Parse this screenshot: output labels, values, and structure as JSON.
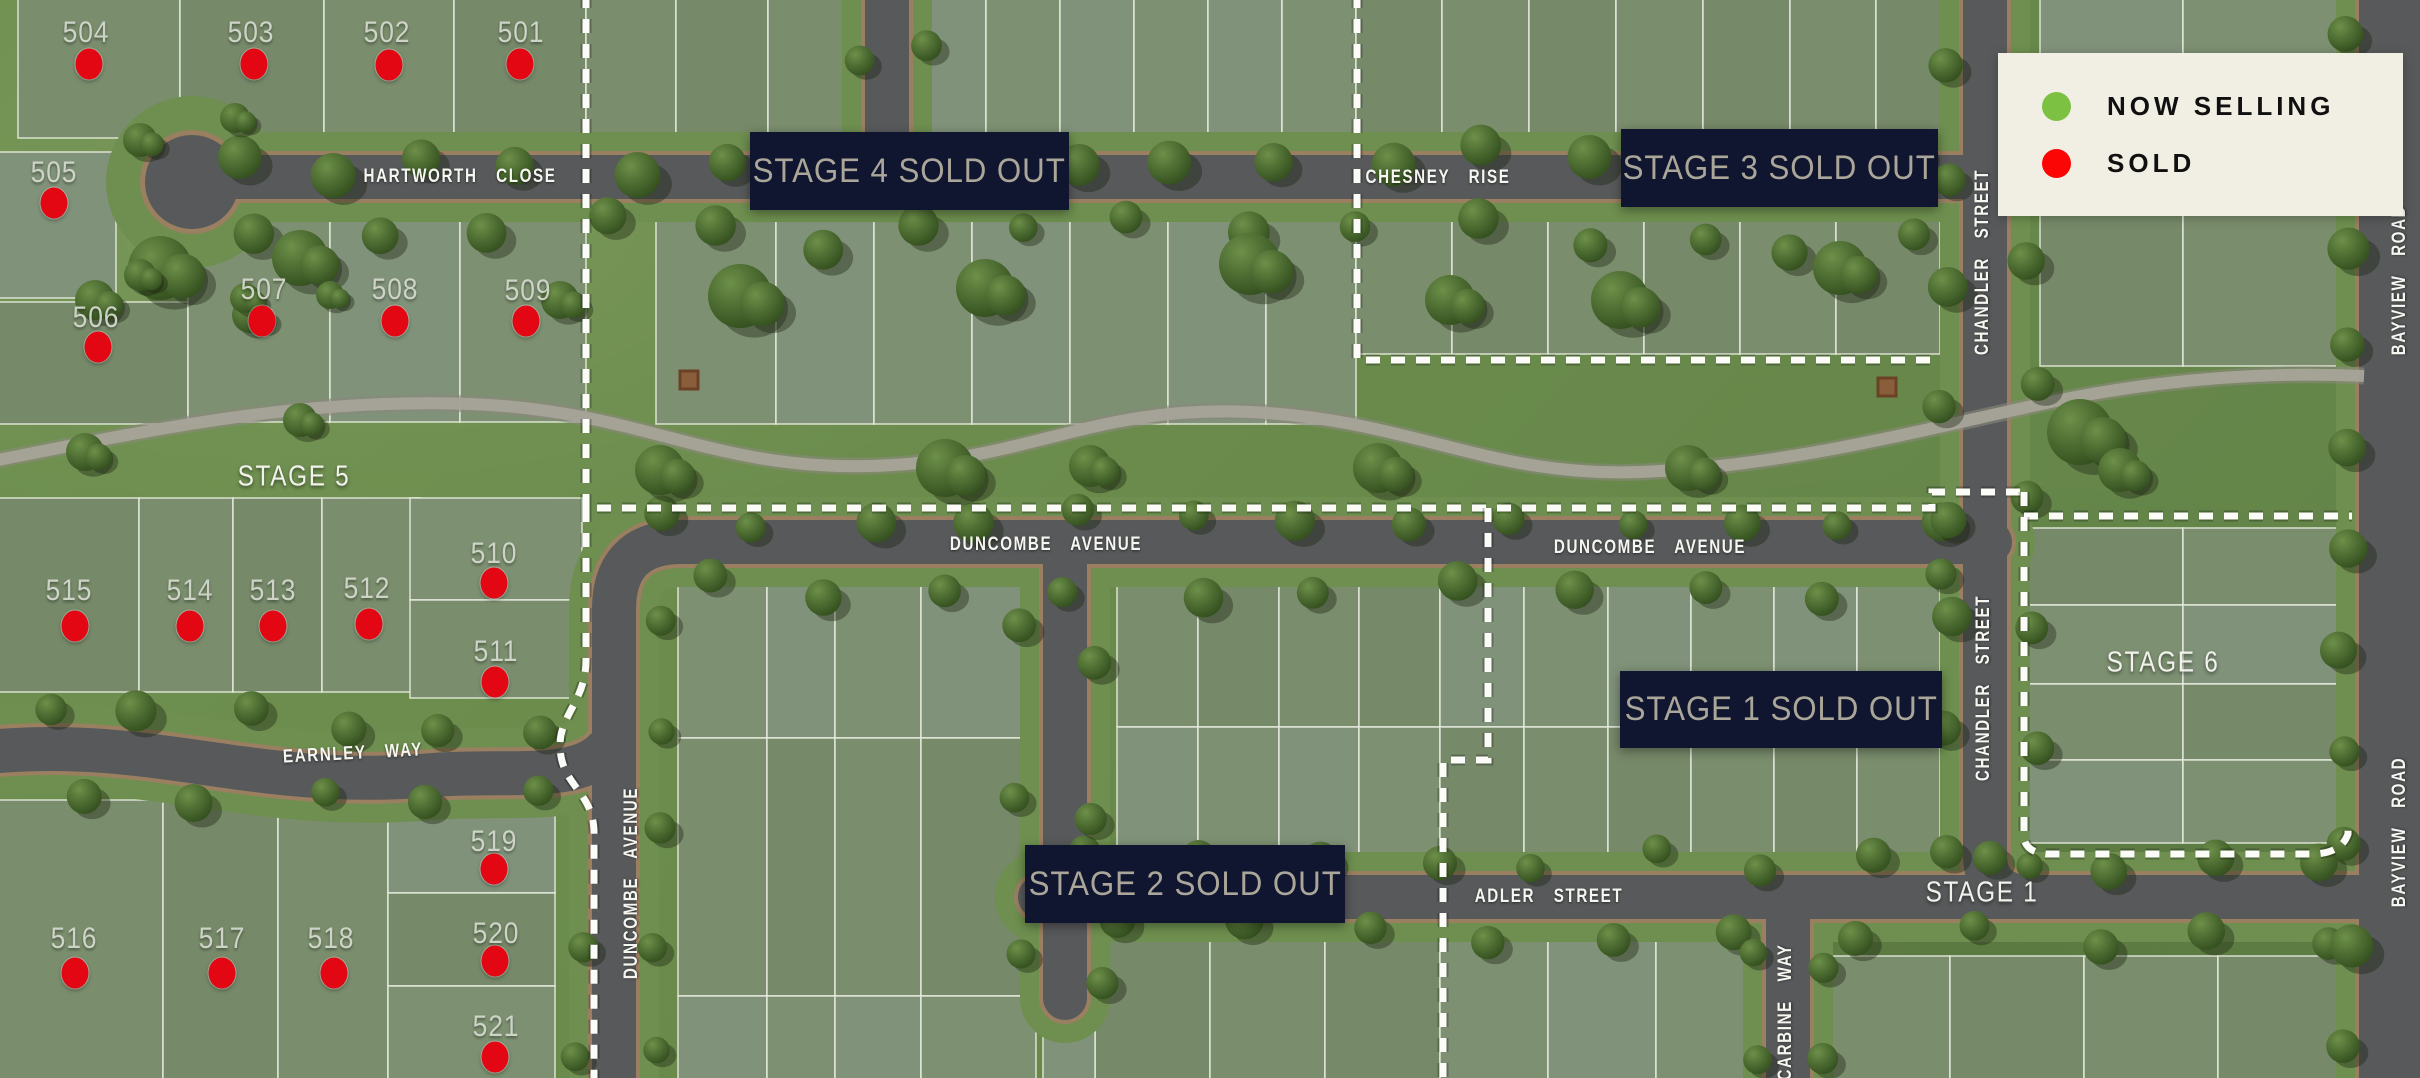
{
  "map_title": "Land estate masterplan",
  "legend": {
    "items": [
      {
        "id": "now-selling",
        "label": "NOW SELLING",
        "color": "#7dc142"
      },
      {
        "id": "sold",
        "label": "SOLD",
        "color": "#fb0505"
      }
    ],
    "x": 1998,
    "y": 53,
    "w": 361,
    "h": 163,
    "bg": "#f1eee3"
  },
  "colors": {
    "sold_dot": "#e30613",
    "banner_bg": "#10162f",
    "banner_text": "#aba69a"
  },
  "stage_banners": [
    {
      "label": "STAGE 4 SOLD OUT",
      "x": 750,
      "y": 132,
      "w": 319,
      "h": 78
    },
    {
      "label": "STAGE 3 SOLD OUT",
      "x": 1621,
      "y": 129,
      "w": 317,
      "h": 78
    },
    {
      "label": "STAGE 1 SOLD OUT",
      "x": 1620,
      "y": 671,
      "w": 322,
      "h": 77
    },
    {
      "label": "STAGE 2 SOLD OUT",
      "x": 1025,
      "y": 845,
      "w": 320,
      "h": 78
    }
  ],
  "stage_area_labels": [
    {
      "label": "STAGE 5",
      "x": 294,
      "y": 477
    },
    {
      "label": "STAGE 6",
      "x": 2163,
      "y": 663
    },
    {
      "label": "STAGE 1",
      "x": 1982,
      "y": 893
    }
  ],
  "streets": [
    {
      "name": "HARTWORTH  CLOSE",
      "x": 460,
      "y": 177,
      "angle": 0
    },
    {
      "name": "CHESNEY  RISE",
      "x": 1438,
      "y": 178,
      "angle": 0
    },
    {
      "name": "DUNCOMBE  AVENUE",
      "x": 1046,
      "y": 545,
      "angle": 0
    },
    {
      "name": "DUNCOMBE  AVENUE",
      "x": 1650,
      "y": 548,
      "angle": 0
    },
    {
      "name": "ADLER  STREET",
      "x": 1549,
      "y": 897,
      "angle": 0
    },
    {
      "name": "EARNLEY  WAY",
      "x": 353,
      "y": 754,
      "angle": -3
    },
    {
      "name": "CHANDLER  STREET",
      "x": 1983,
      "y": 262,
      "angle": -90
    },
    {
      "name": "CHANDLER  STREET",
      "x": 1984,
      "y": 688,
      "angle": -90
    },
    {
      "name": "DUNCOMBE  AVENUE",
      "x": 632,
      "y": 883,
      "angle": -90
    },
    {
      "name": "CARBINE  WAY",
      "x": 1786,
      "y": 1012,
      "angle": -90
    },
    {
      "name": "BAYVIEW  ROAD",
      "x": 2400,
      "y": 280,
      "angle": -90
    },
    {
      "name": "BAYVIEW  ROAD",
      "x": 2400,
      "y": 832,
      "angle": -90
    }
  ],
  "lots": [
    {
      "number": "501",
      "status": "sold",
      "lx": 521,
      "ly": 33,
      "dx": 520,
      "dy": 64
    },
    {
      "number": "502",
      "status": "sold",
      "lx": 387,
      "ly": 33,
      "dx": 389,
      "dy": 65
    },
    {
      "number": "503",
      "status": "sold",
      "lx": 251,
      "ly": 33,
      "dx": 254,
      "dy": 64
    },
    {
      "number": "504",
      "status": "sold",
      "lx": 86,
      "ly": 33,
      "dx": 89,
      "dy": 64
    },
    {
      "number": "505",
      "status": "sold",
      "lx": 54,
      "ly": 173,
      "dx": 54,
      "dy": 203
    },
    {
      "number": "506",
      "status": "sold",
      "lx": 96,
      "ly": 318,
      "dx": 98,
      "dy": 347
    },
    {
      "number": "507",
      "status": "sold",
      "lx": 264,
      "ly": 290,
      "dx": 262,
      "dy": 321
    },
    {
      "number": "508",
      "status": "sold",
      "lx": 395,
      "ly": 290,
      "dx": 395,
      "dy": 321
    },
    {
      "number": "509",
      "status": "sold",
      "lx": 528,
      "ly": 291,
      "dx": 526,
      "dy": 321
    },
    {
      "number": "510",
      "status": "sold",
      "lx": 494,
      "ly": 554,
      "dx": 494,
      "dy": 583
    },
    {
      "number": "511",
      "status": "sold",
      "lx": 496,
      "ly": 652,
      "dx": 495,
      "dy": 682
    },
    {
      "number": "512",
      "status": "sold",
      "lx": 367,
      "ly": 589,
      "dx": 369,
      "dy": 624
    },
    {
      "number": "513",
      "status": "sold",
      "lx": 273,
      "ly": 591,
      "dx": 273,
      "dy": 626
    },
    {
      "number": "514",
      "status": "sold",
      "lx": 190,
      "ly": 591,
      "dx": 190,
      "dy": 626
    },
    {
      "number": "515",
      "status": "sold",
      "lx": 69,
      "ly": 591,
      "dx": 75,
      "dy": 626
    },
    {
      "number": "516",
      "status": "sold",
      "lx": 74,
      "ly": 939,
      "dx": 75,
      "dy": 973
    },
    {
      "number": "517",
      "status": "sold",
      "lx": 222,
      "ly": 939,
      "dx": 222,
      "dy": 973
    },
    {
      "number": "518",
      "status": "sold",
      "lx": 331,
      "ly": 939,
      "dx": 334,
      "dy": 973
    },
    {
      "number": "519",
      "status": "sold",
      "lx": 494,
      "ly": 842,
      "dx": 494,
      "dy": 869
    },
    {
      "number": "520",
      "status": "sold",
      "lx": 496,
      "ly": 934,
      "dx": 495,
      "dy": 961
    },
    {
      "number": "521",
      "status": "sold",
      "lx": 496,
      "ly": 1027,
      "dx": 495,
      "dy": 1057
    }
  ]
}
